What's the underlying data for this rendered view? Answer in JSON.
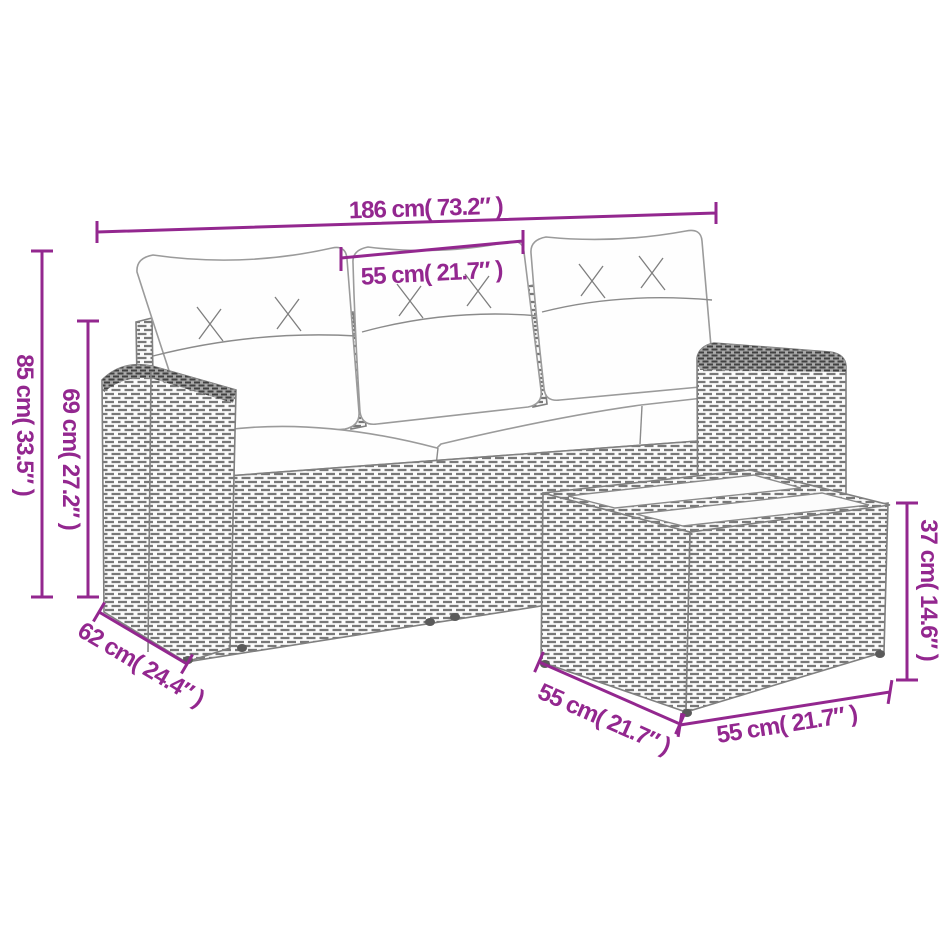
{
  "figure": {
    "kind": "product dimension diagram",
    "subject": "rattan garden sofa set with cushions and side table"
  },
  "colors": {
    "dimension_accent": "#93278F",
    "drawing_line": "#828282",
    "background": "#ffffff"
  },
  "dimensions": [
    {
      "id": "sofa-total-width",
      "label": "186 cm( 73.2″ )"
    },
    {
      "id": "seat-module-width",
      "label": "55 cm( 21.7″ )"
    },
    {
      "id": "sofa-total-height",
      "label": "85 cm( 33.5″ )"
    },
    {
      "id": "sofa-back-height",
      "label": "69 cm( 27.2″ )"
    },
    {
      "id": "sofa-depth",
      "label": "62 cm( 24.4″ )"
    },
    {
      "id": "table-depth",
      "label": "55 cm( 21.7″ )"
    },
    {
      "id": "table-width",
      "label": "55 cm( 21.7″ )"
    },
    {
      "id": "table-height",
      "label": "37 cm( 14.6″ )"
    }
  ]
}
